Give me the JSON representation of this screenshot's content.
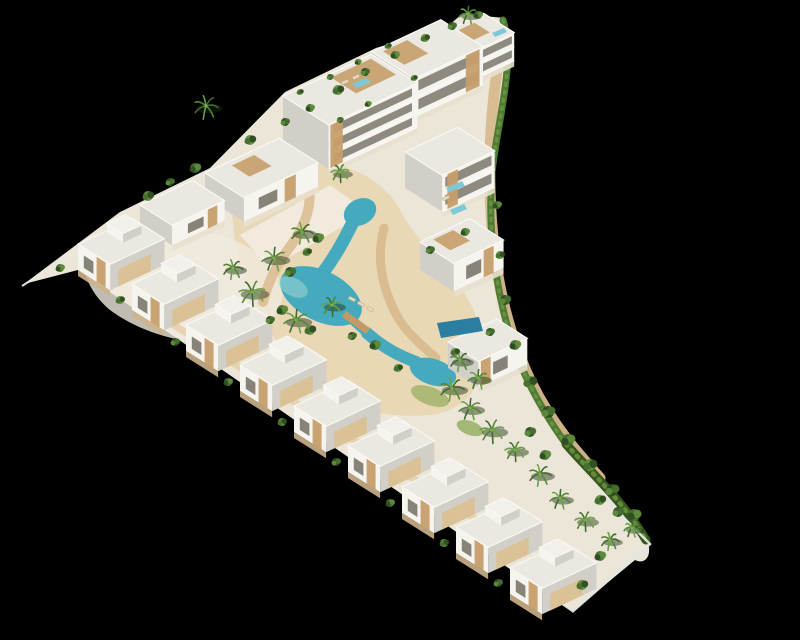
{
  "scene": {
    "title": "aerial 3d render of triangular white residential resort complex with lagoon pool on black background",
    "background": "#000000"
  },
  "palette": {
    "faceBright": "#f6f4ee",
    "faceShadow": "#d2cfc8",
    "roof": "#eae8e1",
    "parapet": "#f9f8f4",
    "glazing": "#746f64",
    "wood": "#c79e6b",
    "woodLight": "#dbc094",
    "sand": "#d8ba8e",
    "sandLight": "#e7d3ab",
    "paveLight": "#f0ebdf",
    "poolWater": "#46aabf",
    "poolDeep": "#2b7ea0",
    "poolLight": "#a7d8d4",
    "roofPool": "#7cc9da",
    "hedgeDark": "#38571f",
    "hedge": "#4e7a33",
    "hedgeLight": "#6d9a44",
    "baseStrip": "#cdb38b",
    "fence": "#e9e7e1"
  },
  "projection": {
    "axisA": [
      0.905,
      -0.425
    ],
    "axisB": [
      0.845,
      0.535
    ]
  },
  "site": {
    "outline": "M24,284 L120,212 L210,168 L285,92 L376,48 L448,26 L462,14 L505,18 C516,60 496,120 491,175 C487,228 494,282 510,334 C522,372 543,410 568,446 C594,476 624,502 648,543 C652,556 645,565 635,560 L572,612 L78,270 Z",
    "fill": "#ece6d8"
  },
  "groundPatches": [
    {
      "d": "M250,160 C320,150 380,170 400,210 C420,250 470,280 480,330 C490,380 470,410 430,415 C370,420 320,400 290,360 C260,320 240,280 235,240 C230,200 228,172 250,160 Z",
      "fill": "#e7d3ab",
      "opacity": 0.75
    },
    {
      "d": "M90,240 C150,215 220,225 260,255 C290,278 290,310 260,330 C220,355 150,340 110,310 C85,290 75,255 90,240 Z",
      "fill": "#f0ebdf",
      "opacity": 0.8
    },
    {
      "d": "M240,235 L330,185 L368,212 L270,268 Z",
      "fill": "#f3efe4",
      "opacity": 0.85
    }
  ],
  "lawns": [
    {
      "cx": 452,
      "cy": 140,
      "rx": 16,
      "ry": 8,
      "rot": -20,
      "fill": "#a9bc72",
      "opacity": 0.85
    },
    {
      "cx": 430,
      "cy": 396,
      "rx": 20,
      "ry": 9,
      "rot": 20,
      "fill": "#9db167",
      "opacity": 0.8
    },
    {
      "cx": 470,
      "cy": 428,
      "rx": 14,
      "ry": 7,
      "rot": 20,
      "fill": "#8ba757",
      "opacity": 0.75
    }
  ],
  "sandPaths": [
    {
      "d": "M499,58 C489,120 487,178 493,238 C498,290 510,338 531,382 C552,424 575,450 600,478",
      "w": 11,
      "c": "#d8ba8e"
    },
    {
      "d": "M302,168 C318,196 306,224 292,244 C278,262 268,282 263,302",
      "w": 10,
      "c": "#dcc096"
    },
    {
      "d": "M384,228 C376,258 382,288 397,316 C406,332 420,344 436,358",
      "w": 9,
      "c": "#d8ba8e"
    },
    {
      "d": "M150,310 C260,380 370,450 500,535",
      "w": 7,
      "c": "#e6d2ae"
    }
  ],
  "pools": {
    "ellipses": [
      {
        "cx": 360,
        "cy": 212,
        "rx": 17,
        "ry": 13,
        "rot": -28
      },
      {
        "cx": 321,
        "cy": 296,
        "rx": 44,
        "ry": 25,
        "rot": 27
      },
      {
        "cx": 433,
        "cy": 372,
        "rx": 24,
        "ry": 13,
        "rot": 18
      }
    ],
    "channels": [
      {
        "d": "M352,224 C342,244 334,258 322,274",
        "w": 13
      },
      {
        "d": "M350,318 L367,333",
        "w": 9
      },
      {
        "d": "M367,333 C385,349 400,356 416,362",
        "w": 12
      }
    ],
    "highlight": {
      "cx": 293,
      "cy": 287,
      "rx": 16,
      "ry": 9,
      "rot": 27,
      "fill": "#a7d8d4",
      "opacity": 0.5
    },
    "privatePool": [
      [
        437,
        323
      ],
      [
        479,
        317
      ],
      [
        483,
        331
      ],
      [
        441,
        338
      ]
    ],
    "roofPools": [
      [
        [
          352,
          84
        ],
        [
          366,
          78
        ],
        [
          371,
          82
        ],
        [
          357,
          88
        ]
      ],
      [
        [
          446,
          188
        ],
        [
          462,
          181
        ],
        [
          465,
          186
        ],
        [
          449,
          192
        ]
      ],
      [
        [
          450,
          210
        ],
        [
          464,
          204
        ],
        [
          467,
          209
        ],
        [
          453,
          215
        ]
      ],
      [
        [
          492,
          33
        ],
        [
          504,
          28
        ],
        [
          507,
          32
        ],
        [
          495,
          37
        ]
      ]
    ],
    "bridge": {
      "d": "M344,314 L368,331",
      "w": 7,
      "c": "#c39a66"
    }
  },
  "blocks": [
    {
      "x": 444,
      "y": 32,
      "a": 44,
      "b": 36,
      "h": 28,
      "f": "B",
      "bands": 2,
      "deck": [
        0.15,
        0.15,
        0.5,
        0.5
      ]
    },
    {
      "x": 372,
      "y": 52,
      "a": 76,
      "b": 50,
      "h": 38,
      "f": "B",
      "bands": 2,
      "wood": [
        0.75,
        0.2
      ],
      "deck": [
        0.1,
        0.1,
        0.35,
        0.5
      ]
    },
    {
      "x": 283,
      "y": 96,
      "a": 98,
      "b": 54,
      "h": 44,
      "f": "B",
      "bands": 3,
      "wood": [
        0.02,
        0.14
      ],
      "deck": [
        0.5,
        0.08,
        0.45,
        0.55
      ]
    },
    {
      "x": 405,
      "y": 152,
      "a": 58,
      "b": 44,
      "h": 36,
      "f": "B",
      "bands": 2,
      "wood": [
        0.1,
        0.2
      ]
    },
    {
      "x": 205,
      "y": 173,
      "a": 82,
      "b": 46,
      "h": 24,
      "f": "B",
      "win": [
        0.2,
        0.25
      ],
      "wood": [
        0.55,
        0.15
      ],
      "deck": [
        0.3,
        0.12,
        0.3,
        0.45
      ]
    },
    {
      "x": 140,
      "y": 205,
      "a": 58,
      "b": 38,
      "h": 20,
      "f": "B",
      "win": [
        0.3,
        0.3
      ],
      "wood": [
        0.68,
        0.18
      ]
    },
    {
      "x": 420,
      "y": 242,
      "a": 55,
      "b": 40,
      "h": 28,
      "f": "B",
      "win": [
        0.25,
        0.3
      ],
      "wood": [
        0.6,
        0.2
      ],
      "deck": [
        0.2,
        0.1,
        0.4,
        0.5
      ]
    },
    {
      "x": 448,
      "y": 342,
      "a": 54,
      "b": 36,
      "h": 26,
      "f": "B",
      "win": [
        0.3,
        0.3
      ],
      "wood": [
        0.05,
        0.2
      ]
    },
    {
      "x": 78,
      "y": 244,
      "a": 60,
      "b": 38,
      "h": 26,
      "f": "L",
      "win": [
        0.18,
        0.3
      ],
      "wood": [
        0.58,
        0.28
      ],
      "t": [
        0.5,
        0.06,
        0.34,
        0.5
      ],
      "s": [
        0.15,
        0.6
      ]
    },
    {
      "x": 132,
      "y": 284,
      "a": 60,
      "b": 38,
      "h": 26,
      "f": "L",
      "win": [
        0.18,
        0.3
      ],
      "wood": [
        0.58,
        0.28
      ],
      "t": [
        0.5,
        0.06,
        0.34,
        0.5
      ],
      "s": [
        0.15,
        0.6
      ]
    },
    {
      "x": 186,
      "y": 325,
      "a": 60,
      "b": 38,
      "h": 26,
      "f": "L",
      "win": [
        0.18,
        0.3
      ],
      "wood": [
        0.58,
        0.28
      ],
      "t": [
        0.5,
        0.06,
        0.34,
        0.5
      ],
      "s": [
        0.15,
        0.6
      ]
    },
    {
      "x": 240,
      "y": 365,
      "a": 60,
      "b": 38,
      "h": 26,
      "f": "L",
      "win": [
        0.18,
        0.3
      ],
      "wood": [
        0.58,
        0.28
      ],
      "t": [
        0.5,
        0.06,
        0.34,
        0.5
      ],
      "s": [
        0.15,
        0.6
      ]
    },
    {
      "x": 294,
      "y": 406,
      "a": 60,
      "b": 38,
      "h": 26,
      "f": "L",
      "win": [
        0.18,
        0.3
      ],
      "wood": [
        0.58,
        0.28
      ],
      "t": [
        0.5,
        0.06,
        0.34,
        0.5
      ],
      "s": [
        0.15,
        0.6
      ]
    },
    {
      "x": 348,
      "y": 446,
      "a": 60,
      "b": 38,
      "h": 26,
      "f": "L",
      "win": [
        0.18,
        0.3
      ],
      "wood": [
        0.58,
        0.28
      ],
      "t": [
        0.5,
        0.06,
        0.34,
        0.5
      ],
      "s": [
        0.15,
        0.6
      ]
    },
    {
      "x": 402,
      "y": 487,
      "a": 60,
      "b": 38,
      "h": 26,
      "f": "L",
      "win": [
        0.18,
        0.3
      ],
      "wood": [
        0.58,
        0.28
      ],
      "t": [
        0.5,
        0.06,
        0.34,
        0.5
      ],
      "s": [
        0.15,
        0.6
      ]
    },
    {
      "x": 456,
      "y": 527,
      "a": 60,
      "b": 38,
      "h": 26,
      "f": "L",
      "win": [
        0.18,
        0.3
      ],
      "wood": [
        0.58,
        0.28
      ],
      "t": [
        0.5,
        0.06,
        0.34,
        0.5
      ],
      "s": [
        0.15,
        0.6
      ]
    },
    {
      "x": 510,
      "y": 568,
      "a": 60,
      "b": 38,
      "h": 26,
      "f": "L",
      "win": [
        0.18,
        0.3
      ],
      "wood": [
        0.58,
        0.28
      ],
      "t": [
        0.5,
        0.06,
        0.34,
        0.5
      ],
      "s": [
        0.15,
        0.6
      ]
    }
  ],
  "hedges": [
    {
      "d": "M503,20 C516,62 498,118 492,172 C488,225 494,280 509,332 C520,370 540,408 566,444",
      "w": 7,
      "c": "#4e7a33"
    },
    {
      "d": "M566,444 C594,476 622,500 646,540",
      "w": 9,
      "c": "#38571f"
    }
  ],
  "fences": [
    {
      "d": "M22,286 L78,250",
      "w": 2,
      "c": "#e9e7e1"
    },
    {
      "d": "M600,494 L650,544 L572,612",
      "w": 2.5,
      "c": "#e3e7e4"
    }
  ],
  "trees": [
    {
      "x": 206,
      "y": 106,
      "r": 12,
      "t": "p"
    },
    {
      "x": 468,
      "y": 14,
      "r": 9,
      "t": "p"
    },
    {
      "x": 340,
      "y": 172,
      "r": 9,
      "t": "p"
    },
    {
      "x": 302,
      "y": 232,
      "r": 11,
      "t": "p"
    },
    {
      "x": 274,
      "y": 258,
      "r": 12,
      "t": "p"
    },
    {
      "x": 252,
      "y": 292,
      "r": 13,
      "t": "p"
    },
    {
      "x": 233,
      "y": 268,
      "r": 10,
      "t": "p"
    },
    {
      "x": 296,
      "y": 320,
      "r": 12,
      "t": "p"
    },
    {
      "x": 332,
      "y": 305,
      "r": 10,
      "t": "p"
    },
    {
      "x": 452,
      "y": 388,
      "r": 12,
      "t": "p"
    },
    {
      "x": 470,
      "y": 408,
      "r": 11,
      "t": "p"
    },
    {
      "x": 492,
      "y": 430,
      "r": 12,
      "t": "p"
    },
    {
      "x": 460,
      "y": 360,
      "r": 10,
      "t": "p"
    },
    {
      "x": 478,
      "y": 378,
      "r": 10,
      "t": "p"
    },
    {
      "x": 515,
      "y": 450,
      "r": 10,
      "t": "p"
    },
    {
      "x": 540,
      "y": 474,
      "r": 11,
      "t": "p"
    },
    {
      "x": 560,
      "y": 498,
      "r": 10,
      "t": "p"
    },
    {
      "x": 585,
      "y": 520,
      "r": 10,
      "t": "p"
    },
    {
      "x": 610,
      "y": 540,
      "r": 9,
      "t": "p"
    },
    {
      "x": 632,
      "y": 528,
      "r": 8,
      "t": "p"
    },
    {
      "x": 148,
      "y": 196,
      "r": 5,
      "t": "b"
    },
    {
      "x": 170,
      "y": 182,
      "r": 4,
      "t": "b"
    },
    {
      "x": 195,
      "y": 168,
      "r": 5,
      "t": "b"
    },
    {
      "x": 250,
      "y": 140,
      "r": 5,
      "t": "b"
    },
    {
      "x": 285,
      "y": 122,
      "r": 4,
      "t": "b"
    },
    {
      "x": 310,
      "y": 108,
      "r": 4,
      "t": "b"
    },
    {
      "x": 338,
      "y": 90,
      "r": 5,
      "t": "b"
    },
    {
      "x": 365,
      "y": 72,
      "r": 4,
      "t": "b"
    },
    {
      "x": 395,
      "y": 55,
      "r": 4,
      "t": "b"
    },
    {
      "x": 425,
      "y": 38,
      "r": 4,
      "t": "b"
    },
    {
      "x": 452,
      "y": 26,
      "r": 4,
      "t": "b"
    },
    {
      "x": 478,
      "y": 15,
      "r": 4,
      "t": "b"
    },
    {
      "x": 300,
      "y": 92,
      "r": 3,
      "t": "b"
    },
    {
      "x": 330,
      "y": 77,
      "r": 3,
      "t": "b"
    },
    {
      "x": 358,
      "y": 62,
      "r": 3,
      "t": "b"
    },
    {
      "x": 388,
      "y": 46,
      "r": 3,
      "t": "b"
    },
    {
      "x": 340,
      "y": 120,
      "r": 3,
      "t": "b"
    },
    {
      "x": 368,
      "y": 104,
      "r": 3,
      "t": "b"
    },
    {
      "x": 414,
      "y": 78,
      "r": 3,
      "t": "b"
    },
    {
      "x": 430,
      "y": 250,
      "r": 4,
      "t": "b"
    },
    {
      "x": 465,
      "y": 232,
      "r": 4,
      "t": "b"
    },
    {
      "x": 455,
      "y": 352,
      "r": 4,
      "t": "b"
    },
    {
      "x": 490,
      "y": 332,
      "r": 4,
      "t": "b"
    },
    {
      "x": 318,
      "y": 238,
      "r": 5,
      "t": "b"
    },
    {
      "x": 307,
      "y": 252,
      "r": 4,
      "t": "b"
    },
    {
      "x": 290,
      "y": 272,
      "r": 5,
      "t": "b"
    },
    {
      "x": 282,
      "y": 310,
      "r": 5,
      "t": "b"
    },
    {
      "x": 310,
      "y": 330,
      "r": 5,
      "t": "b"
    },
    {
      "x": 352,
      "y": 336,
      "r": 4,
      "t": "b"
    },
    {
      "x": 375,
      "y": 345,
      "r": 5,
      "t": "b"
    },
    {
      "x": 398,
      "y": 368,
      "r": 4,
      "t": "b"
    },
    {
      "x": 270,
      "y": 320,
      "r": 4,
      "t": "b"
    },
    {
      "x": 497,
      "y": 205,
      "r": 4,
      "t": "b"
    },
    {
      "x": 500,
      "y": 255,
      "r": 4,
      "t": "b"
    },
    {
      "x": 505,
      "y": 300,
      "r": 5,
      "t": "b"
    },
    {
      "x": 515,
      "y": 345,
      "r": 5,
      "t": "b"
    },
    {
      "x": 530,
      "y": 382,
      "r": 6,
      "t": "b"
    },
    {
      "x": 548,
      "y": 412,
      "r": 6,
      "t": "b"
    },
    {
      "x": 568,
      "y": 440,
      "r": 6,
      "t": "b"
    },
    {
      "x": 590,
      "y": 465,
      "r": 6,
      "t": "b"
    },
    {
      "x": 612,
      "y": 490,
      "r": 6,
      "t": "b"
    },
    {
      "x": 634,
      "y": 515,
      "r": 6,
      "t": "b"
    },
    {
      "x": 600,
      "y": 500,
      "r": 5,
      "t": "b"
    },
    {
      "x": 618,
      "y": 512,
      "r": 5,
      "t": "b"
    },
    {
      "x": 600,
      "y": 556,
      "r": 5,
      "t": "b"
    },
    {
      "x": 582,
      "y": 585,
      "r": 5,
      "t": "b"
    },
    {
      "x": 530,
      "y": 432,
      "r": 5,
      "t": "b"
    },
    {
      "x": 545,
      "y": 455,
      "r": 5,
      "t": "b"
    },
    {
      "x": 120,
      "y": 300,
      "r": 4,
      "t": "b"
    },
    {
      "x": 175,
      "y": 342,
      "r": 4,
      "t": "b"
    },
    {
      "x": 228,
      "y": 382,
      "r": 4,
      "t": "b"
    },
    {
      "x": 282,
      "y": 422,
      "r": 4,
      "t": "b"
    },
    {
      "x": 336,
      "y": 462,
      "r": 4,
      "t": "b"
    },
    {
      "x": 390,
      "y": 503,
      "r": 4,
      "t": "b"
    },
    {
      "x": 444,
      "y": 543,
      "r": 4,
      "t": "b"
    },
    {
      "x": 498,
      "y": 583,
      "r": 4,
      "t": "b"
    },
    {
      "x": 60,
      "y": 268,
      "r": 4,
      "t": "b"
    }
  ],
  "loungers": [
    {
      "x": 352,
      "y": 299,
      "rot": 27
    },
    {
      "x": 361,
      "y": 304,
      "rot": 27
    },
    {
      "x": 370,
      "y": 309,
      "rot": 27
    },
    {
      "x": 345,
      "y": 82,
      "rot": -25
    },
    {
      "x": 356,
      "y": 77,
      "rot": -25
    },
    {
      "x": 446,
      "y": 198,
      "rot": -25
    }
  ]
}
